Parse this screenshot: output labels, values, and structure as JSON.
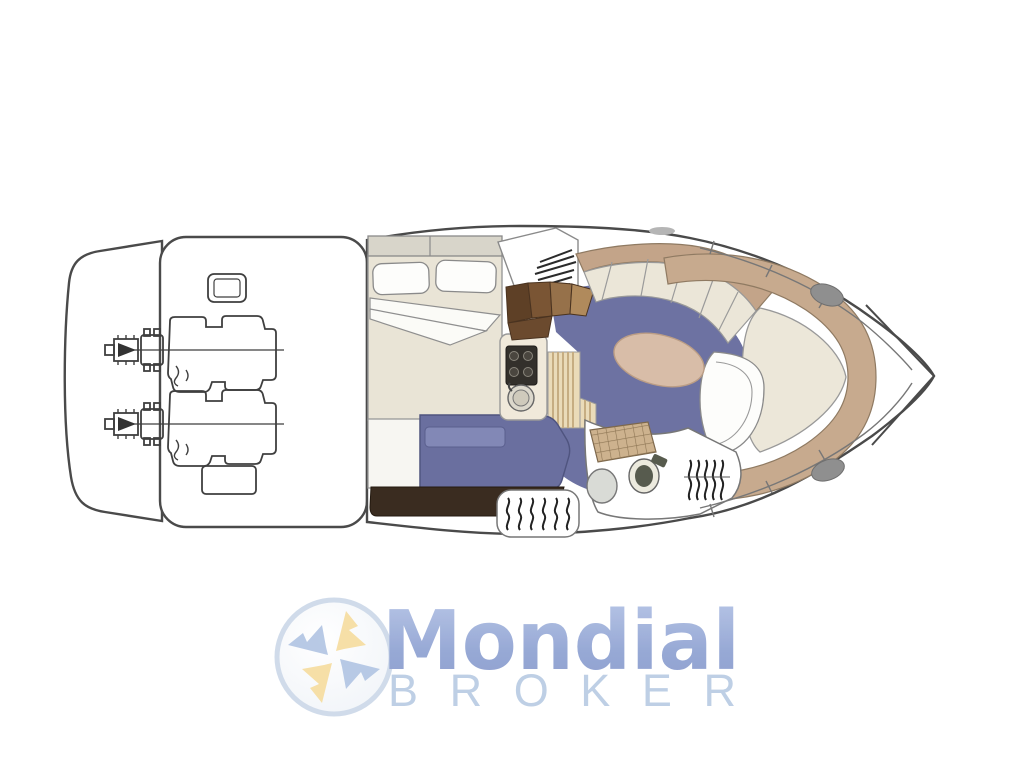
{
  "watermark": {
    "brand": "Mondial",
    "wordmark_secondary": "BROKER",
    "emblem": "compass-pinwheel-icon"
  },
  "diagram": {
    "kind": "yacht-floor-plan-top-view",
    "orientation": "bow-right-stern-left"
  },
  "palette": {
    "background": "#ffffff",
    "hull_outline": "#4a4a4a",
    "salon_floor_blue": "#6d72a2",
    "sofa_blue": "#6a6f9f",
    "upholstery_cream": "#ebe6d8",
    "trim_tan": "#c7aa8e",
    "table_tan": "#d8bda8",
    "stairs_brown": "#8a5f3a",
    "cabinet_dark_brown": "#3a2c20",
    "wood_floor": "#eadbb9",
    "shower_tile_tan": "#cdb28e",
    "hatch_gray": "#8f8f8f",
    "logo_blue_dark": "#8698cc",
    "logo_blue_light": "#b4c3e6",
    "logo_sub_blue": "#b9cce3",
    "logo_yellow": "#f6dc9c",
    "logo_ring": "#cdd9e9"
  }
}
